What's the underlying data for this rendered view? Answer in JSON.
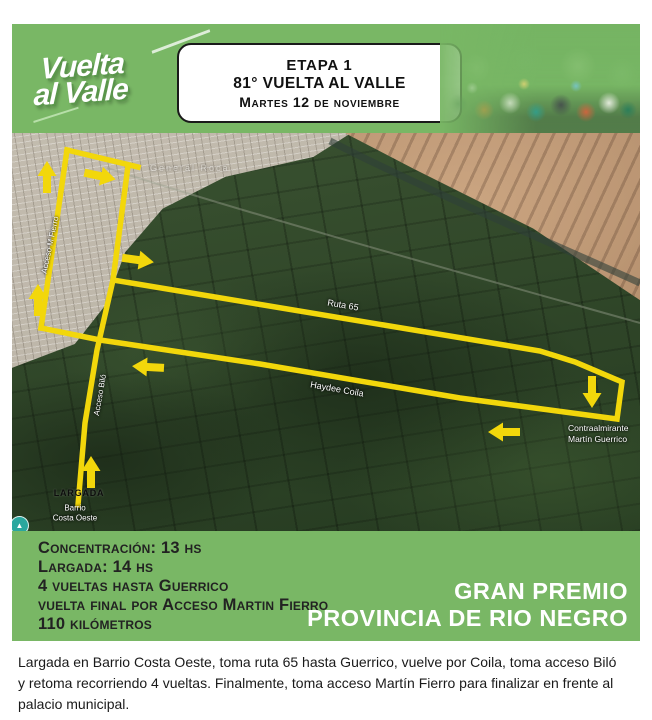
{
  "colors": {
    "band_green": "#79B765",
    "route_yellow": "#F2D70B",
    "map_farm": "#2F4428",
    "city": "#B5AEA1",
    "mountain": "#B08A6C",
    "stage_text": "#111111",
    "band_text": "#222222",
    "footer_text": "#1A1A1A",
    "icon_teal": "#2AA79E"
  },
  "header": {
    "logo_line1": "Vuelta",
    "logo_line2": "al Valle",
    "stage_box": {
      "line1": "ETAPA 1",
      "line2": "81° VUELTA AL VALLE",
      "line3": "Martes 12 de noviembre"
    }
  },
  "map": {
    "city_watermark": "General Roca",
    "street_fierro": "Acceso M Fierro",
    "street_bilo": "Acceso Biló",
    "street_ruta": "Ruta 65",
    "street_coila": "Haydee Coila",
    "town_line1": "Contraalmirante",
    "town_line2": "Martín Guerrico",
    "start_label": "LARGADA",
    "barrio_line1": "Barrio",
    "barrio_line2": "Costa Oeste"
  },
  "info_band": {
    "lines": [
      "Concentración: 13 hs",
      "Largada: 14 hs",
      "4 vueltas hasta Guerrico",
      "vuelta final por Acceso Martin Fierro",
      "110 kilómetros"
    ],
    "right_line1": "GRAN PREMIO",
    "right_line2": "PROVINCIA DE RIO NEGRO"
  },
  "footer": {
    "paragraph": "Largada en Barrio Costa Oeste, toma ruta 65 hasta Guerrico, vuelve por Coila, toma acceso Biló y retoma recorriendo 4 vueltas. Finalmente, toma acceso Martín Fierro para finalizar en frente al palacio municipal."
  }
}
